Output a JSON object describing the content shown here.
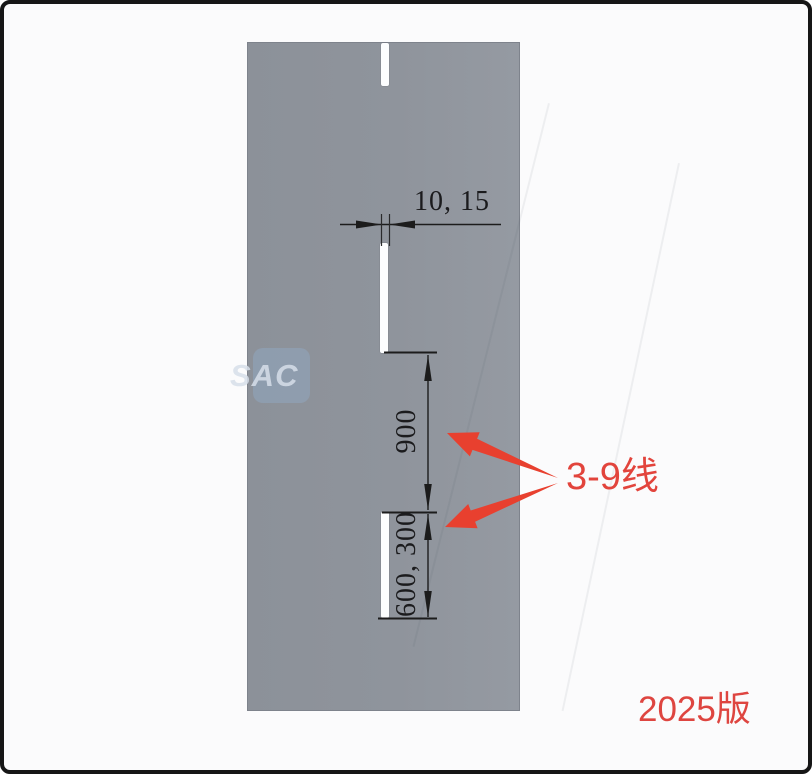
{
  "diagram": {
    "dimension_labels": {
      "gap": "10, 15",
      "segment_length": "900",
      "dash_length": "600, 300"
    },
    "callout_label": "3-9线",
    "version_label": "2025版",
    "watermark_text": "SAC",
    "colors": {
      "panel_gray": "#8f949c",
      "accent_red": "#e8402f",
      "line_black": "#1c1c1c"
    }
  }
}
